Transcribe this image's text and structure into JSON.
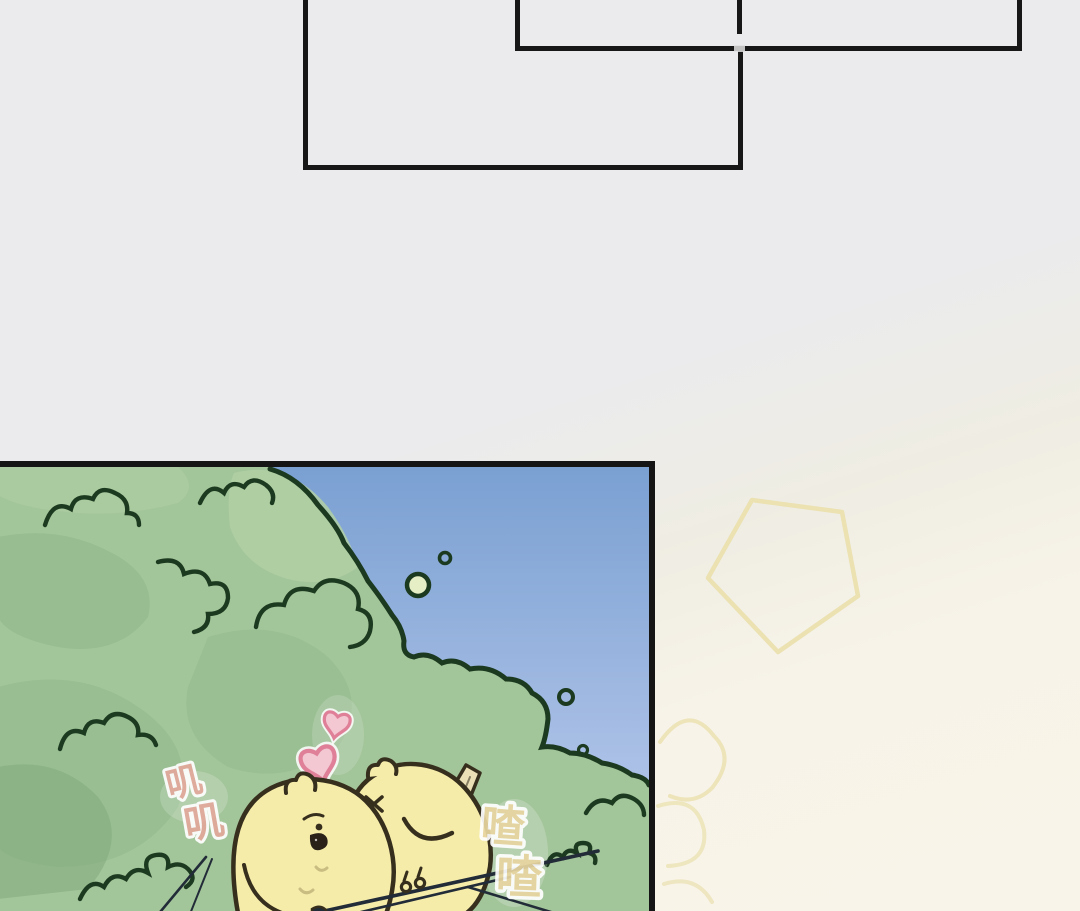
{
  "page": {
    "kind": "webtoon comic page",
    "background_top_color": "#ebebed",
    "background_bottom_color": "#f8f4e9",
    "panel_border_color": "#171717",
    "empty_panel_count": 2
  },
  "comic": {
    "border_color": "#151515",
    "sfx_left_word": "叽叽",
    "sfx_left_chars": [
      "叽",
      "叽"
    ],
    "sfx_right_word": "喳喳",
    "sfx_right_chars": [
      "喳",
      "喳"
    ],
    "colors": {
      "sky_top": "#7aa0d2",
      "sky_bottom": "#b2c5e9",
      "bush_base": "#a3c59a",
      "bush_light": "#b2d0a4",
      "bush_mid": "#93ba8e",
      "bush_dark": "#83ab7f",
      "bush_outline": "#1c3a1f",
      "chick_body": "#f6ecaa",
      "chick_outline": "#372f1d",
      "chick_wing": "#ebdfb6",
      "chick_beak": "#2a2118",
      "chest_mark": "#c9bd82",
      "heart_stroke": "#df8098",
      "heart_fill": "#f3c8d2",
      "sfx_left_color": "#e2a89b",
      "sfx_right_color": "#e8d5a0",
      "branch_color": "#222c38",
      "bubble_fill": "#e6eec6"
    }
  },
  "decor": {
    "outline_color": "#eadfab",
    "shapes": [
      "pentagon",
      "petals"
    ]
  }
}
